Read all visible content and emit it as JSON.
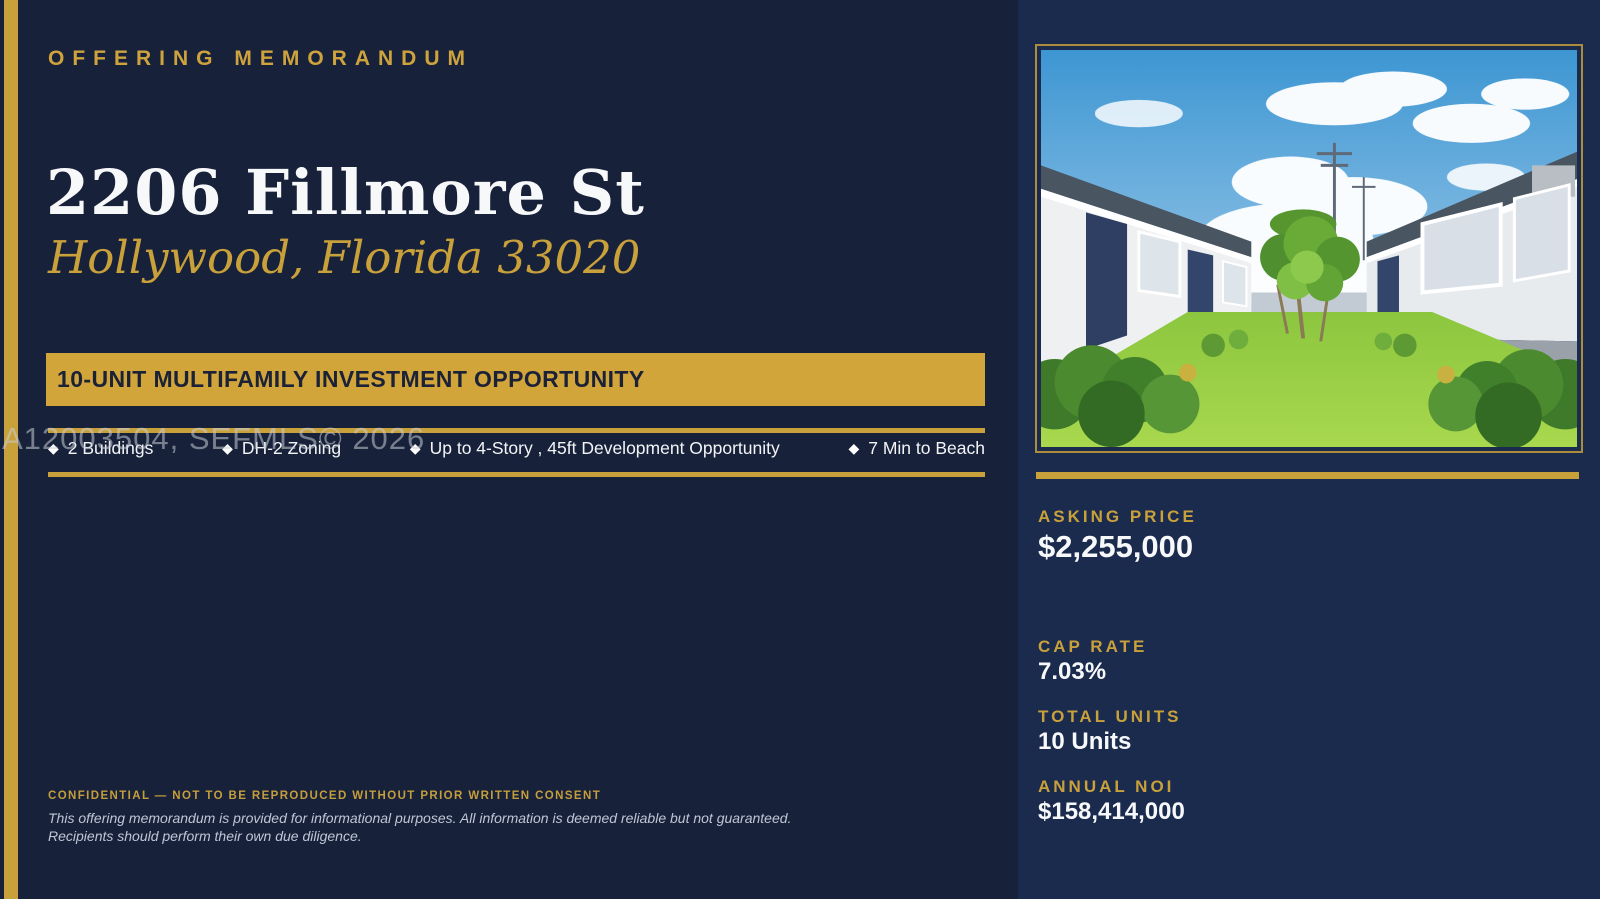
{
  "colors": {
    "background_left": "#18213a",
    "background_right": "#1b2b4e",
    "gold_accent": "#c9a13a",
    "banner_gold": "#d2a53b",
    "banner_text": "#1b2136",
    "title_white": "#f7f8fa"
  },
  "header": {
    "eyebrow": "OFFERING MEMORANDUM"
  },
  "property": {
    "title": "2206 Fillmore St",
    "location": "Hollywood, Florida 33020"
  },
  "banner": {
    "label": "10-UNIT MULTIFAMILY INVESTMENT OPPORTUNITY"
  },
  "highlights": {
    "bullet_glyph": "◆",
    "items": [
      "2 Buildings",
      "DH-2 Zoning",
      "Up to 4-Story , 45ft Development Opportunity",
      "7 Min to Beach"
    ]
  },
  "watermark": {
    "text": "A12003504, SEFMLS© 2026"
  },
  "footer": {
    "confidential": "CONFIDENTIAL — NOT TO BE REPRODUCED WITHOUT PRIOR WRITTEN CONSENT",
    "disclaimer_line1": "This offering memorandum is provided for informational purposes. All information is deemed reliable but not guaranteed.",
    "disclaimer_line2": "Recipients should perform their own due diligence."
  },
  "sidebar": {
    "photo": "property-exterior-photo",
    "stats": [
      {
        "label": "ASKING PRICE",
        "value": "$2,255,000"
      },
      {
        "label": "CAP RATE",
        "value": "7.03%"
      },
      {
        "label": "TOTAL UNITS",
        "value": "10 Units"
      },
      {
        "label": "ANNUAL NOI",
        "value": "$158,414,000"
      }
    ]
  }
}
